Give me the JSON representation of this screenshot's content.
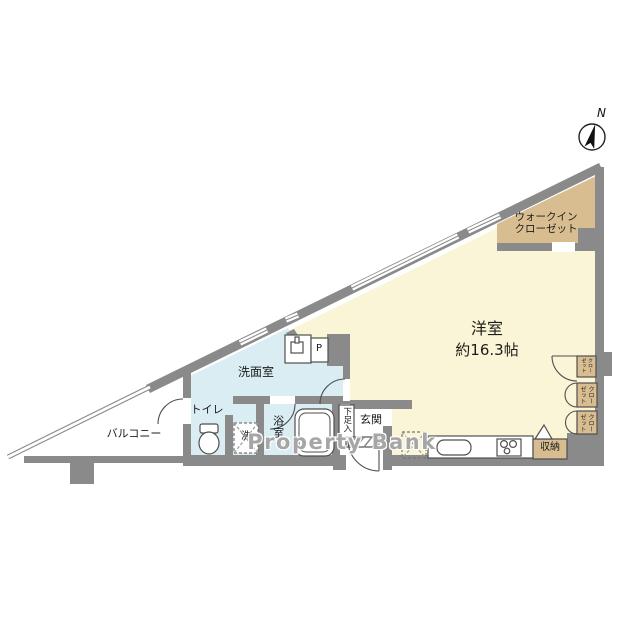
{
  "floorplan": {
    "watermark": "Property Bank",
    "compass": "N",
    "labels": {
      "main_room_name": "洋室",
      "main_room_area": "約16.3帖",
      "walk_in_closet_line1": "ウォークイン",
      "walk_in_closet_line2": "クローゼット",
      "washroom": "洗面室",
      "toilet": "トイレ",
      "bathroom": "浴室",
      "balcony": "バルコニー",
      "entrance": "玄関",
      "shoe_cupboard": "下足入",
      "storage": "収納",
      "closet": "クローゼット",
      "washing_machine": "洗",
      "refrigerator": "冷",
      "pipe_space": "P"
    },
    "colors": {
      "wall_gray": "#8a8a8a",
      "main_room_fill": "#faf5d6",
      "wet_area_fill": "#d9edf3",
      "closet_fill": "#d8bd90",
      "line_dark": "#4f4f4f",
      "watermark_gray": "#969696"
    }
  }
}
